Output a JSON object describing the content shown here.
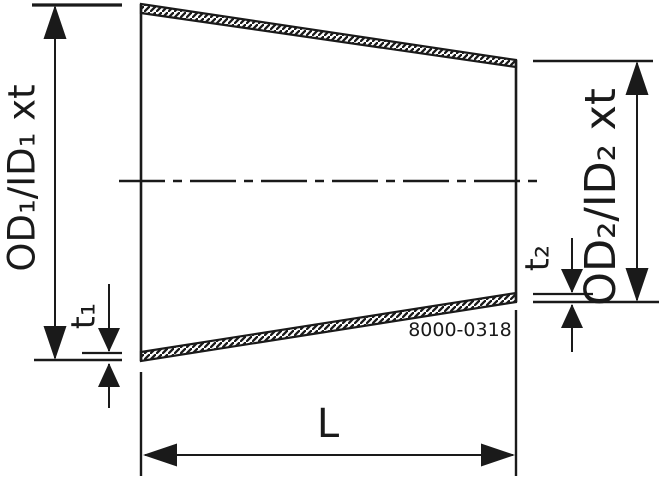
{
  "drawing": {
    "labels": {
      "od1": "OD₁/ID₁ xt",
      "t1": "t₁",
      "od2": "OD₂/ID₂ xt",
      "t2": "t₂",
      "length": "L",
      "drawing_number": "8000-0318"
    },
    "colors": {
      "line": "#1a1a1a",
      "background": "#ffffff"
    }
  }
}
